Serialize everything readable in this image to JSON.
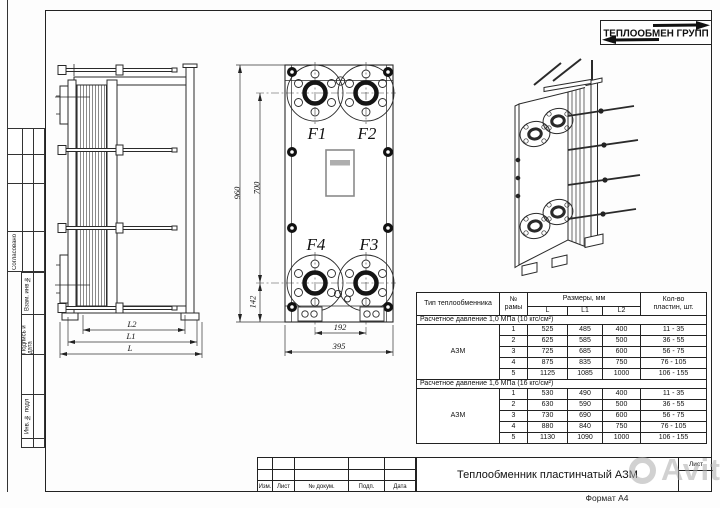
{
  "logo": {
    "name": "ТЕПЛООБМЕН ГРУПП"
  },
  "margin": {
    "approved": "Согласовано",
    "replaced_inv": "Взам. инв №",
    "sign_date": "Подпись и дата",
    "inventory": "Инв. № подл"
  },
  "drawing": {
    "side": {
      "dim_l2": "L2",
      "dim_l1": "L1",
      "dim_l": "L"
    },
    "front": {
      "f1": "F1",
      "f2": "F2",
      "f3": "F3",
      "f4": "F4",
      "dim_height": "960",
      "dim_ports_v": "700",
      "dim_bottom": "142",
      "dim_ports_h": "192",
      "dim_width": "395"
    }
  },
  "table": {
    "header": {
      "type": "Тип теплообменника",
      "frame_no": [
        "№",
        "рамы"
      ],
      "sizes": "Размеры, мм",
      "size_cols": [
        "L",
        "L1",
        "L2"
      ],
      "plates": [
        "Кол-во",
        "пластин, шт."
      ]
    },
    "sections": [
      {
        "header": "Расчетное давление 1,0 МПа (10 кгс/см²)",
        "type": "АЗМ",
        "rows": [
          [
            "1",
            "525",
            "485",
            "400",
            "11 - 35"
          ],
          [
            "2",
            "625",
            "585",
            "500",
            "36 - 55"
          ],
          [
            "3",
            "725",
            "685",
            "600",
            "56 - 75"
          ],
          [
            "4",
            "875",
            "835",
            "750",
            "76 - 105"
          ],
          [
            "5",
            "1125",
            "1085",
            "1000",
            "106 - 155"
          ]
        ]
      },
      {
        "header": "Расчетное давление 1,6 МПа (16 кгс/см²)",
        "type": "АЗМ",
        "rows": [
          [
            "1",
            "530",
            "490",
            "400",
            "11 - 35"
          ],
          [
            "2",
            "630",
            "590",
            "500",
            "36 - 55"
          ],
          [
            "3",
            "730",
            "690",
            "600",
            "56 - 75"
          ],
          [
            "4",
            "880",
            "840",
            "750",
            "76 - 105"
          ],
          [
            "5",
            "1130",
            "1090",
            "1000",
            "106 - 155"
          ]
        ]
      }
    ]
  },
  "title_block": {
    "revision_labels": [
      "Изм.",
      "Лист",
      "№ докум.",
      "Подп.",
      "Дата"
    ],
    "title": "Теплообменник пластинчатый АЗМ",
    "sheet_label": "Лист",
    "format_label": "Формат А4"
  },
  "watermark": {
    "text": "Avito"
  }
}
